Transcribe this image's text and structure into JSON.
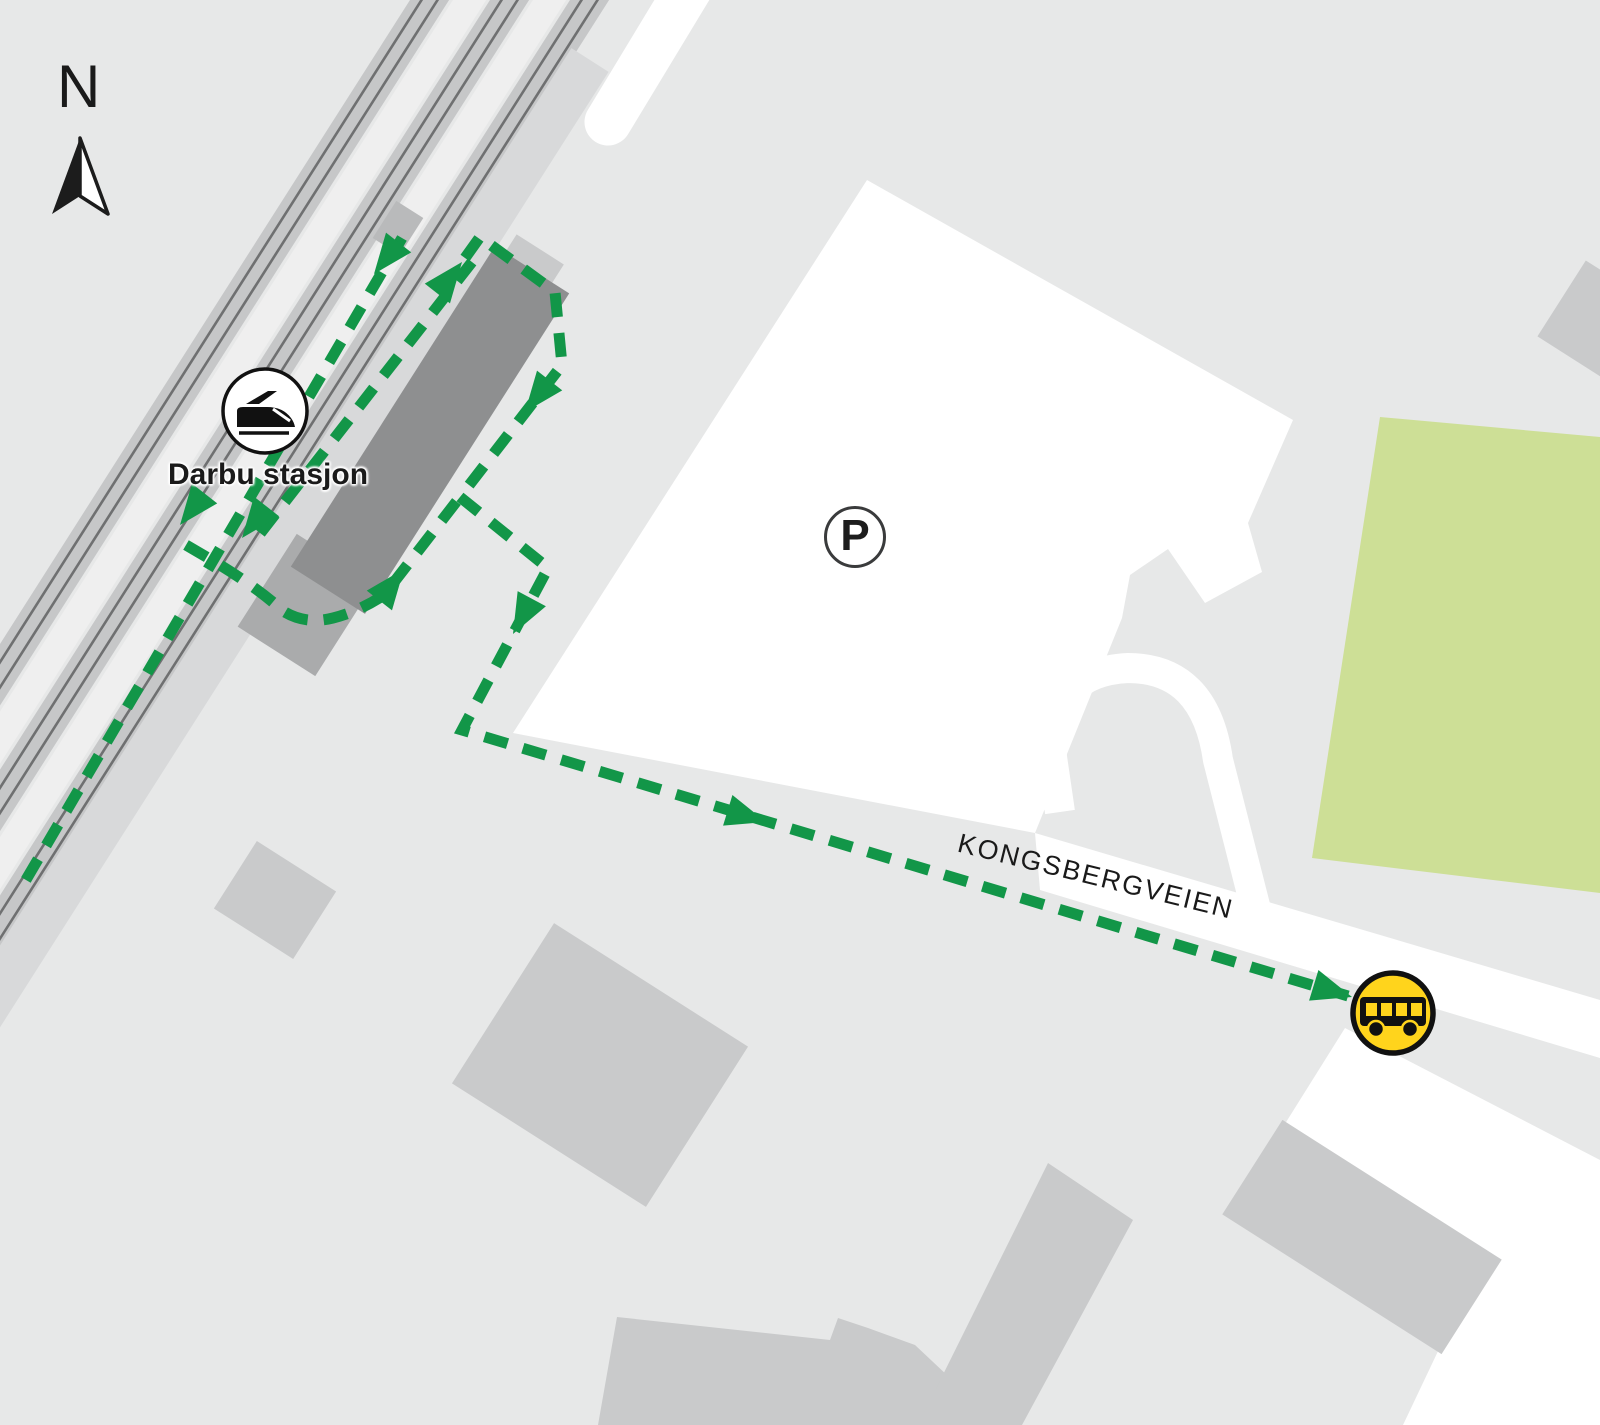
{
  "map": {
    "type": "transit-wayfinding-map",
    "labels": {
      "north": "N",
      "station": "Darbu stasjon",
      "street": "KONGSBERGVEIEN",
      "parking": "P"
    },
    "icons": [
      {
        "name": "north-compass-icon",
        "meaning": "north direction"
      },
      {
        "name": "train-icon",
        "meaning": "railway station (Darbu stasjon)"
      },
      {
        "name": "parking-icon",
        "meaning": "parking area"
      },
      {
        "name": "bus-icon",
        "meaning": "bus stop"
      }
    ],
    "route": {
      "style": "dashed-with-arrows",
      "color": "#129648"
    },
    "colors": {
      "bg": "#e7e8e8",
      "road_white": "#ffffff",
      "building_gray": "#c9cacb",
      "station_gray": "#8e8f90",
      "track_gray": "#c6c7c8",
      "rail_dark": "#6f7071",
      "platform_gray": "#d8d9da",
      "field_green": "#cddf96",
      "route_green": "#129648",
      "bus_yellow": "#ffd41c",
      "label_black": "#1a1a1a"
    }
  }
}
